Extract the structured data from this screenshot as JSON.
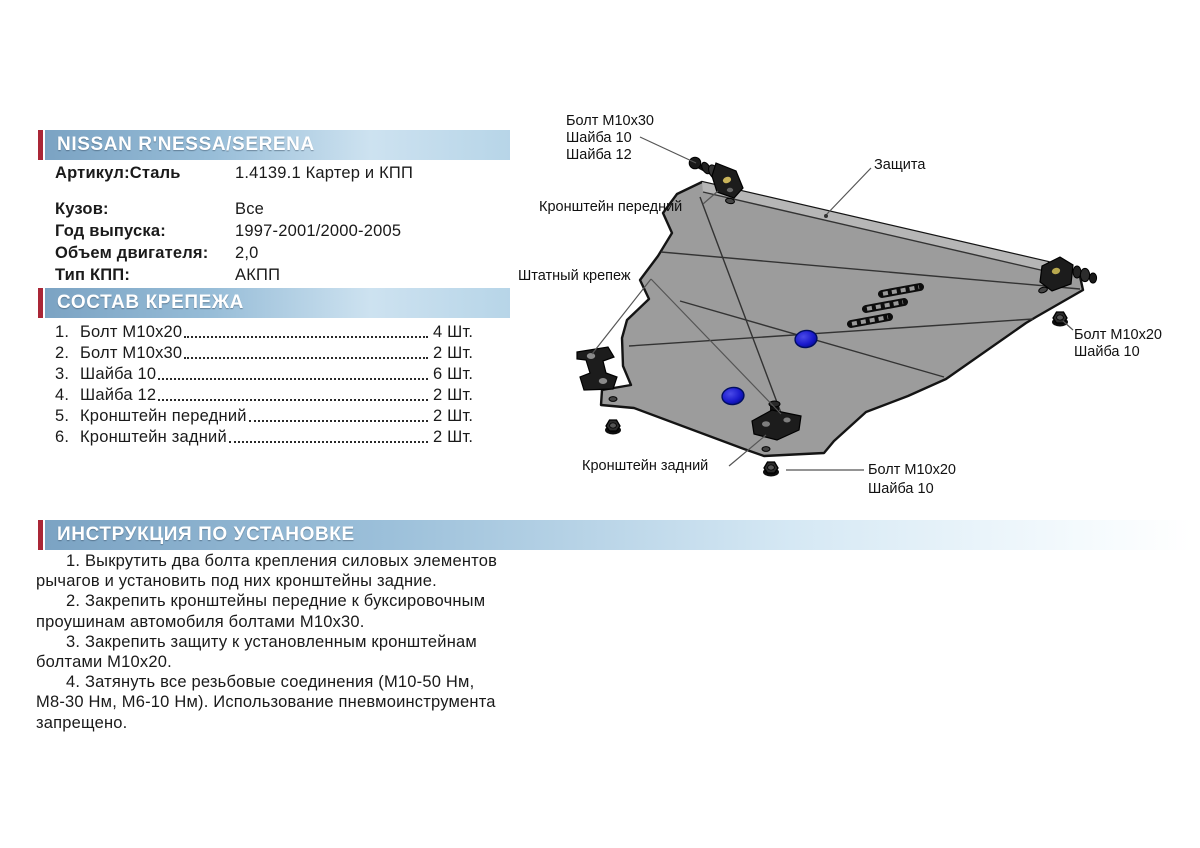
{
  "product": {
    "title": "NISSAN R'NESSA/SERENA",
    "sku_label": "Артикул:Сталь",
    "sku_value": "1.4139.1 Картер и КПП",
    "specs": [
      {
        "label": "Кузов:",
        "value": "Все"
      },
      {
        "label": "Год выпуска:",
        "value": "1997-2001/2000-2005"
      },
      {
        "label": "Объем двигателя:",
        "value": "2,0"
      },
      {
        "label": "Тип КПП:",
        "value": "АКПП"
      }
    ]
  },
  "hardware": {
    "header": "СОСТАВ КРЕПЕЖА",
    "items": [
      {
        "num": "1.",
        "name": "Болт M10x20",
        "qty": "4 Шт."
      },
      {
        "num": "2.",
        "name": "Болт M10x30",
        "qty": "2 Шт."
      },
      {
        "num": "3.",
        "name": "Шайба 10",
        "qty": "6 Шт."
      },
      {
        "num": "4.",
        "name": "Шайба 12",
        "qty": "2 Шт."
      },
      {
        "num": "5.",
        "name": "Кронштейн передний",
        "qty": "2 Шт."
      },
      {
        "num": "6.",
        "name": "Кронштейн задний",
        "qty": "2 Шт."
      }
    ]
  },
  "instructions": {
    "header": "ИНСТРУКЦИЯ ПО УСТАНОВКЕ",
    "steps": [
      {
        "lines": [
          "1. Выкрутить два болта крепления силовых элементов",
          "рычагов и установить под них кронштейны задние."
        ]
      },
      {
        "lines": [
          "2. Закрепить кронштейны передние к буксировочным",
          "проушинам автомобиля болтами M10x30."
        ]
      },
      {
        "lines": [
          "3. Закрепить защиту к установленным кронштейнам",
          "болтами M10x20."
        ]
      },
      {
        "lines": [
          "4. Затянуть все резьбовые соединения (M10-50 Нм,",
          "M8-30 Нм, M6-10 Нм). Использование пневмоинструмента",
          "запрещено."
        ]
      }
    ]
  },
  "diagram": {
    "labels": {
      "bolt_front": [
        "Болт M10x30",
        "Шайба 10",
        "Шайба 12"
      ],
      "shield": "Защита",
      "bracket_front": "Кронштейн передний",
      "stock_fastener": "Штатный крепеж",
      "bolt_right": [
        "Болт M10x20",
        "Шайба 10"
      ],
      "bracket_rear": "Кронштейн задний",
      "bolt_bottom": [
        "Болт M10x20",
        "Шайба 10"
      ]
    }
  },
  "colors": {
    "accent_red": "#aa2636",
    "bar_blue_start": "#7ba3c3",
    "bar_blue_end": "#b7d5e8",
    "plate_gray": "#9c9c9c",
    "fastener_blue": "#1a1acc"
  }
}
